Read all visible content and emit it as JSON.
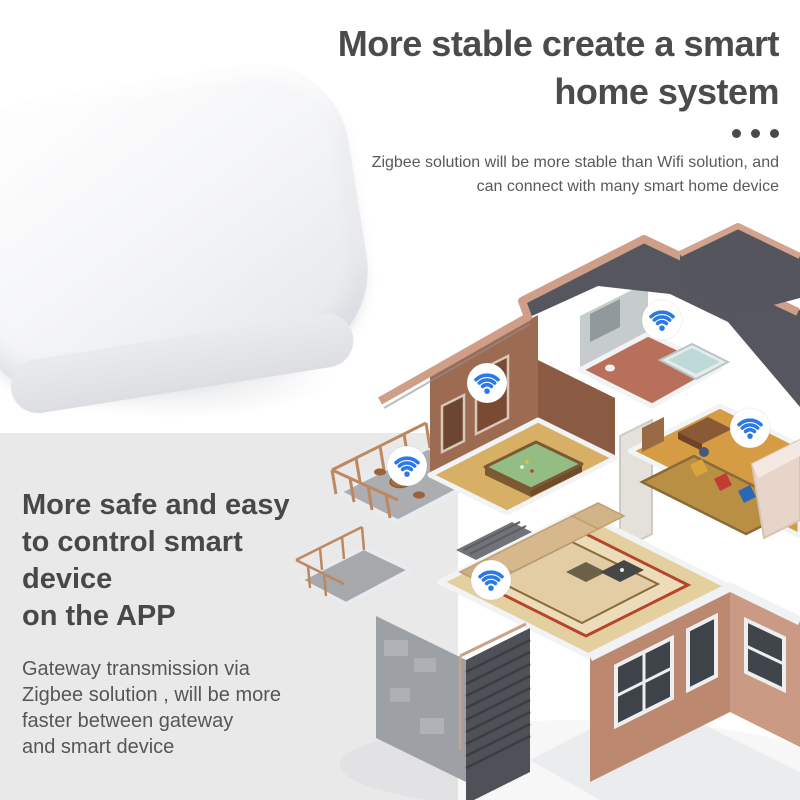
{
  "hero": {
    "title_lines": [
      "More stable create a smart",
      "home system"
    ],
    "subtitle_lines": [
      "Zigbee solution will be more stable than Wifi solution, and",
      "can connect with many smart home device"
    ]
  },
  "feature": {
    "title_lines": [
      "More safe and easy",
      "to control smart",
      "device",
      "on the APP"
    ],
    "body_lines": [
      "Gateway transmission via",
      "Zigbee solution , will be more",
      "faster between gateway",
      "and smart device"
    ]
  },
  "house": {
    "wifi_badge_count": 5,
    "rooms": [
      "balcony",
      "billiard-room",
      "bathroom",
      "bedroom",
      "living-room"
    ]
  },
  "icons": {
    "wifi": "wifi-icon",
    "dots": "ellipsis-dots"
  },
  "colors": {
    "accent_blue": "#2b78e8",
    "heading_text": "#4b4b4d",
    "body_text": "#59595b",
    "panel_gray": "#e9e9ea",
    "roof_slate": "#56575e",
    "parapet_tan": "#cf9e89",
    "wall_brown": "#9c6b51",
    "exterior_salmon": "#c28a72",
    "device_white": "#f3f4f6"
  }
}
